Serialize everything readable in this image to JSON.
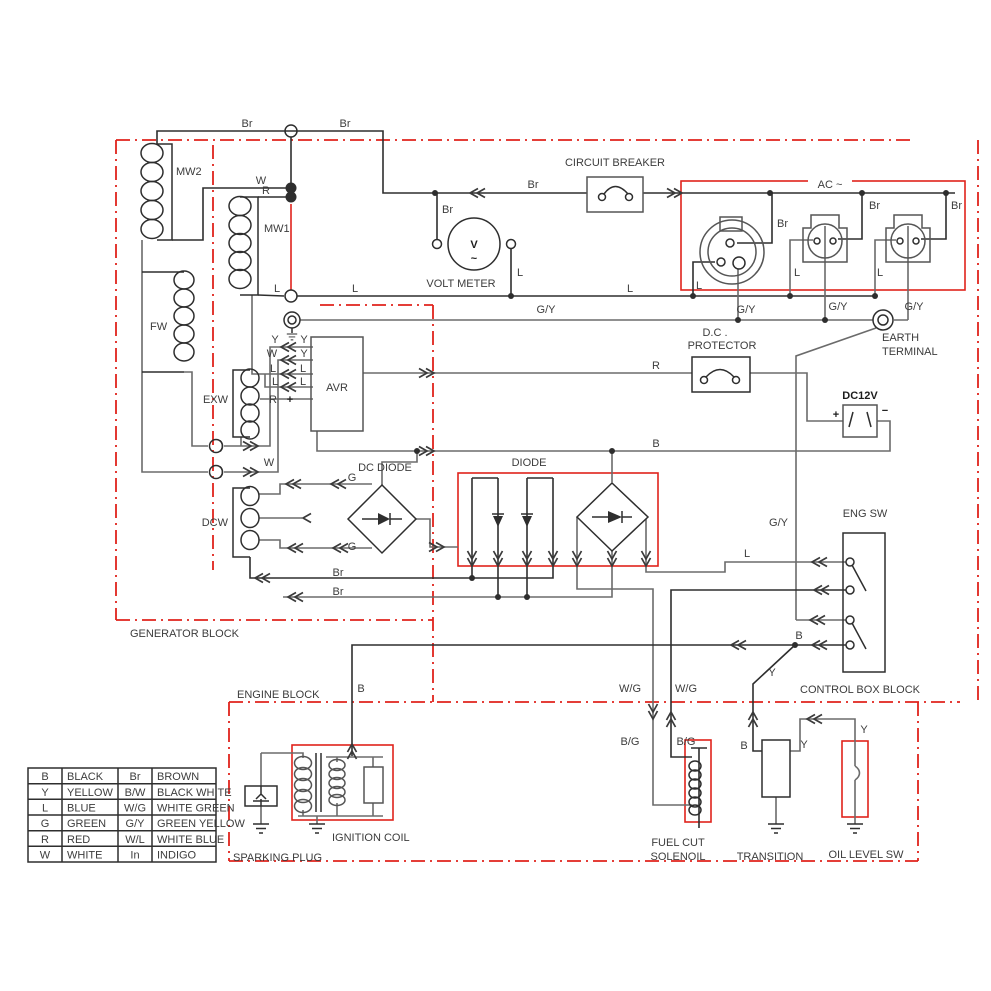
{
  "diagram_title": "generator-wiring-schematic",
  "colors": {
    "region_red": "#e0231c",
    "wire_black": "#2e2e2e",
    "wire_gray": "#6b6b6b",
    "background": "#ffffff"
  },
  "blocks": {
    "generator": "GENERATOR BLOCK",
    "engine": "ENGINE BLOCK",
    "control": "CONTROL BOX BLOCK"
  },
  "components": {
    "mw2": "MW2",
    "mw1": "MW1",
    "fw": "FW",
    "exw": "EXW",
    "dcw": "DCW",
    "avr": "AVR",
    "volt_meter": "VOLT METER",
    "circuit_breaker": "CIRCUIT BREAKER",
    "ac": "AC ~",
    "earth1": "EARTH",
    "earth2": "TERMINAL",
    "dcp1": "D.C .",
    "dcp2": "PROTECTOR",
    "dc12v": "DC12V",
    "plus_small": "+",
    "plus": "+",
    "minus": "−",
    "dc_diode": "DC DIODE",
    "diode": "DIODE",
    "eng_sw": "ENG SW",
    "ignition_coil": "IGNITION COIL",
    "sparking_plug": "SPARKING PLUG",
    "fuel_cut1": "FUEL CUT",
    "fuel_cut2": "SOLENOIL",
    "transition": "TRANSITION",
    "oil_level": "OIL LEVEL SW",
    "v": "V",
    "tilde": "~"
  },
  "wire_codes": {
    "br1": "Br",
    "br2": "Br",
    "br3": "Br",
    "br4": "Br",
    "br5": "Br",
    "br6": "Br",
    "br7": "Br",
    "br8": "Br",
    "br9": "Br",
    "w1": "W",
    "w2": "W",
    "w3": "W",
    "r1": "R",
    "r2": "R",
    "r3": "R",
    "l1": "L",
    "l2": "L",
    "l3": "L",
    "l4": "L",
    "l5": "L",
    "l6": "L",
    "l7": "L",
    "l8": "L",
    "l_avr_l1": "L",
    "l_avr_r1": "L",
    "l_avr_l2": "L",
    "l_avr_r2": "L",
    "y_avr_l": "Y",
    "y_avr_r1": "Y",
    "y_avr_r2": "Y",
    "y1": "Y",
    "y2": "Y",
    "y3": "Y",
    "gy1": "G/Y",
    "gy2": "G/Y",
    "gy3": "G/Y",
    "gy4": "G/Y",
    "gy5": "G/Y",
    "g1": "G",
    "g2": "G",
    "b1": "B",
    "b2": "B",
    "b3": "B",
    "b4": "B",
    "wg1": "W/G",
    "wg2": "W/G",
    "bg1": "B/G",
    "bg2": "B/G"
  },
  "legend": {
    "rows": [
      {
        "c1": "B",
        "n1": "BLACK",
        "c2": "Br",
        "n2": "BROWN"
      },
      {
        "c1": "Y",
        "n1": "YELLOW",
        "c2": "B/W",
        "n2": "BLACK  WHITE"
      },
      {
        "c1": "L",
        "n1": "BLUE",
        "c2": "W/G",
        "n2": "WHITE GREEN"
      },
      {
        "c1": "G",
        "n1": "GREEN",
        "c2": "G/Y",
        "n2": "GREEN YELLOW"
      },
      {
        "c1": "R",
        "n1": "RED",
        "c2": "W/L",
        "n2": "WHITE BLUE"
      },
      {
        "c1": "W",
        "n1": "WHITE",
        "c2": "In",
        "n2": "INDIGO"
      }
    ]
  }
}
